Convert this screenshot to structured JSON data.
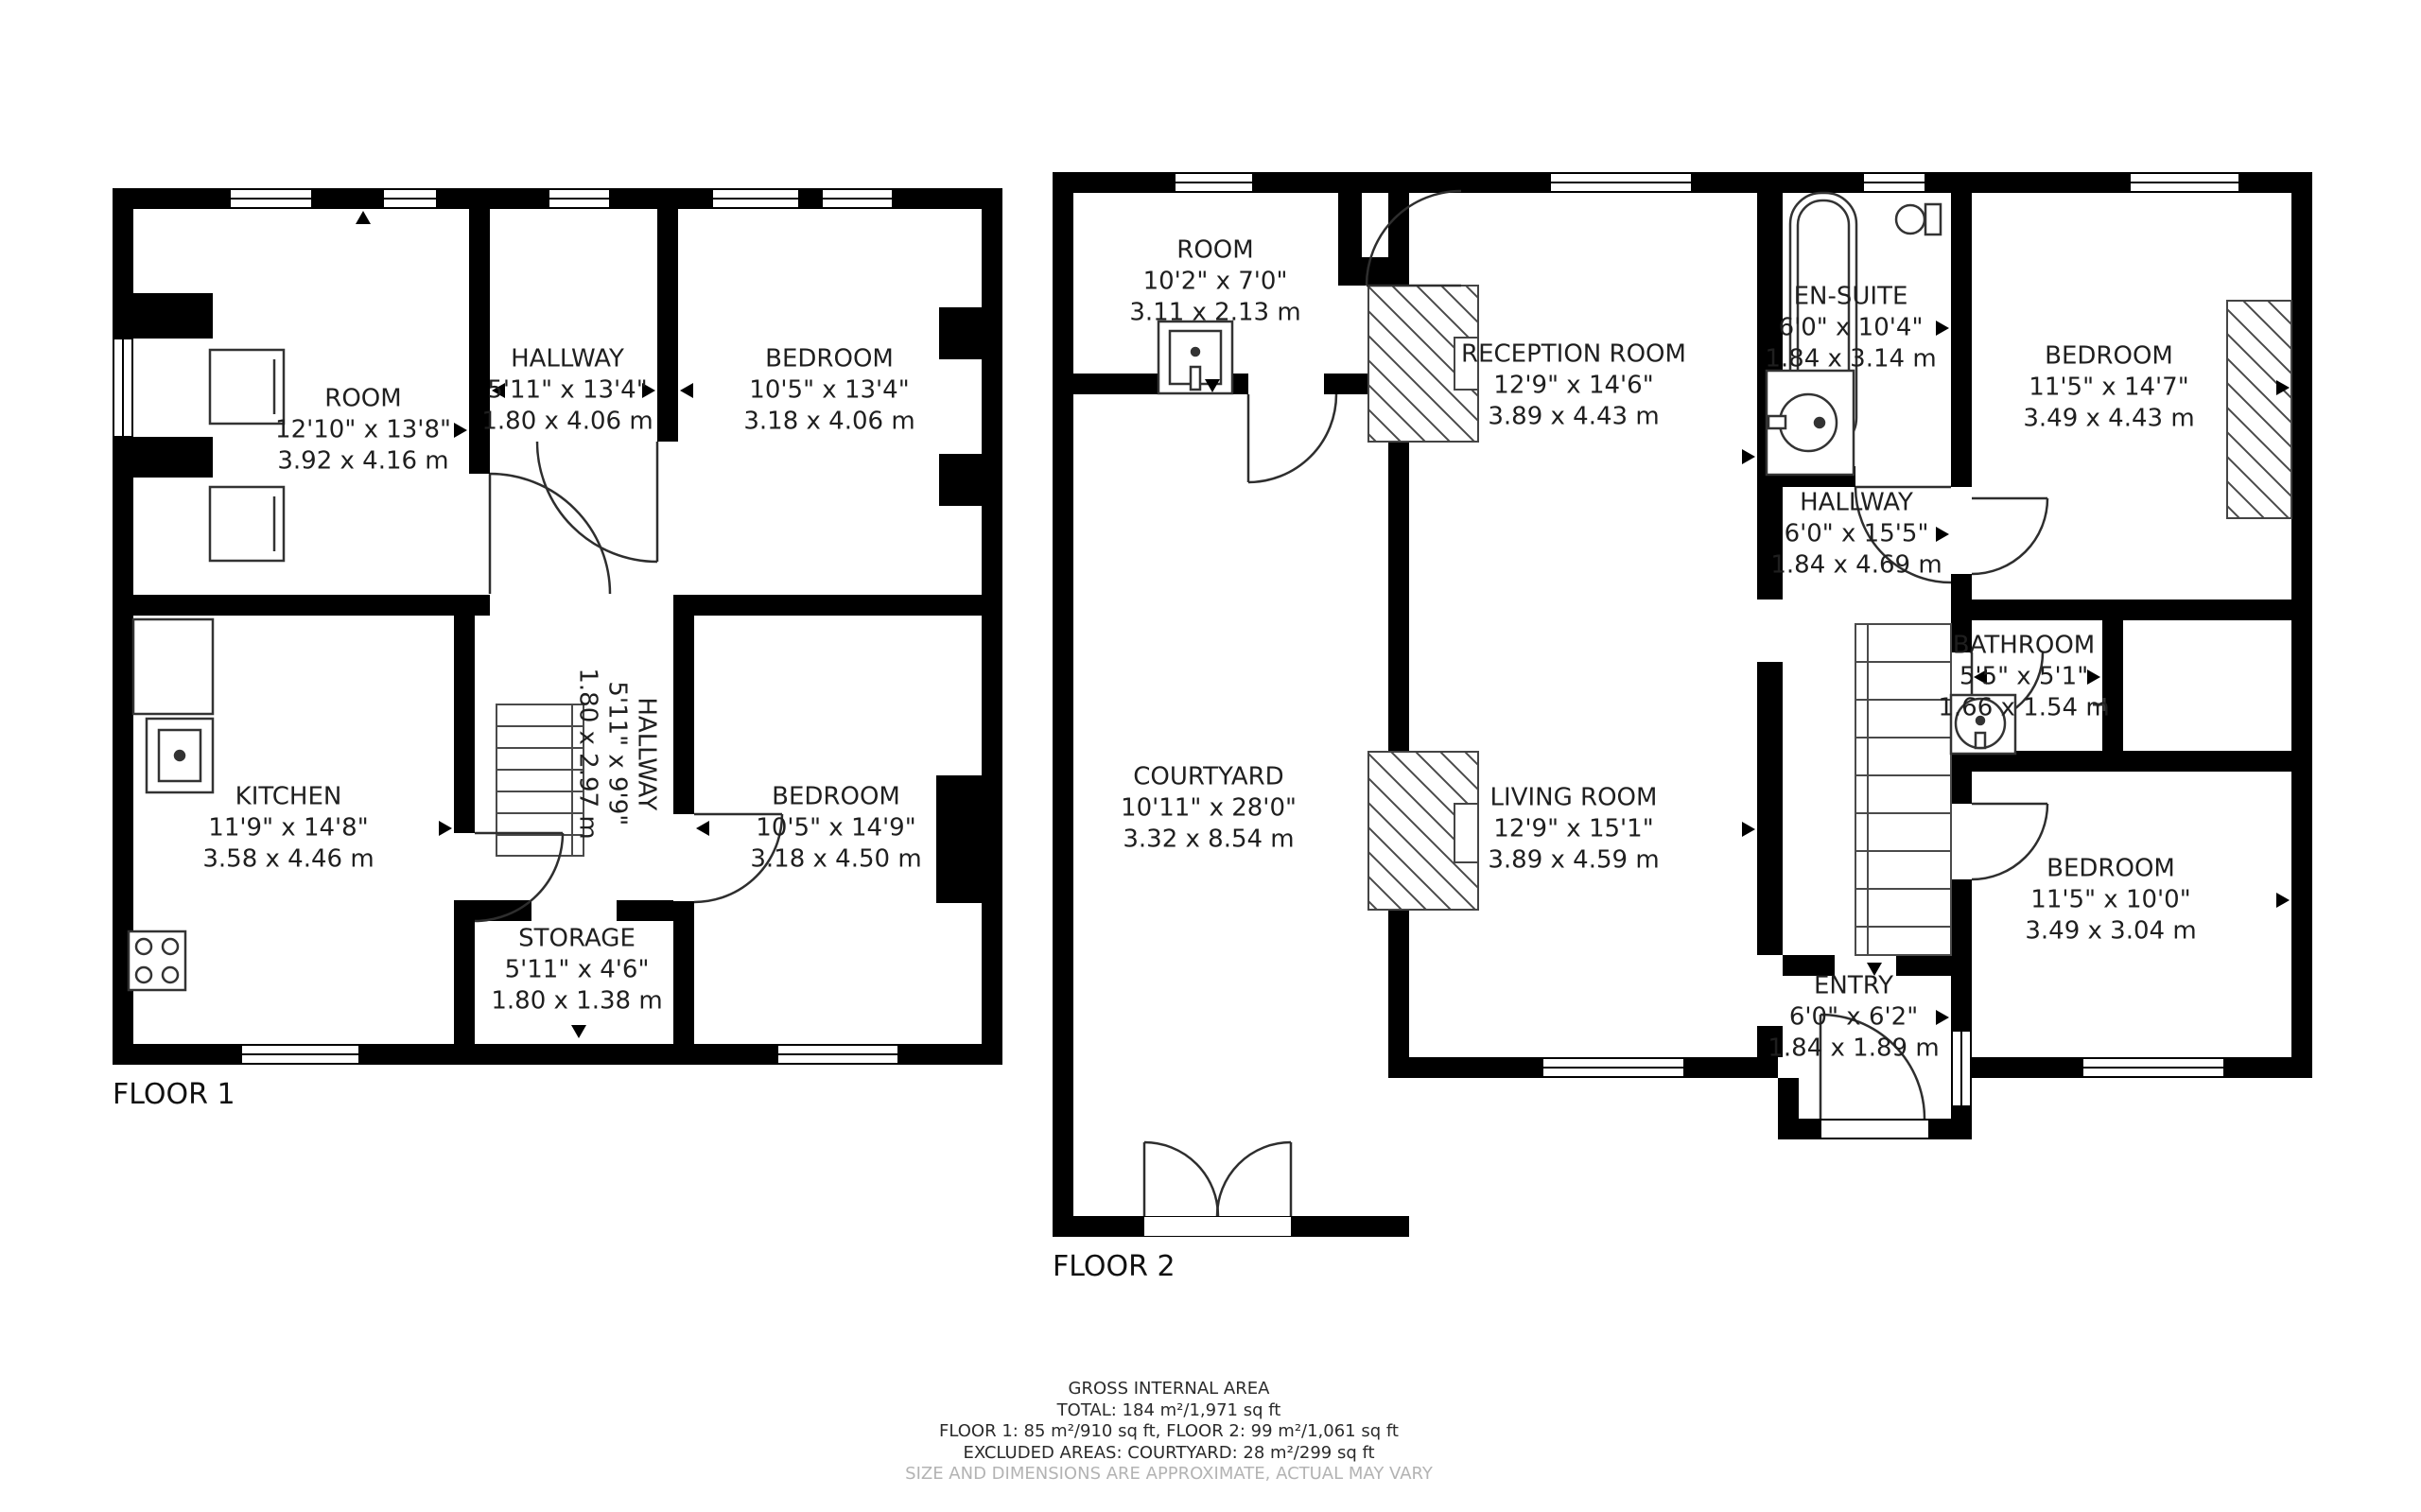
{
  "floor1": {
    "label": "FLOOR 1",
    "rooms": {
      "room": {
        "name": "ROOM",
        "imperial": "12'10\" x 13'8\"",
        "metric": "3.92 x 4.16 m"
      },
      "hallway_top": {
        "name": "HALLWAY",
        "imperial": "5'11\" x 13'4\"",
        "metric": "1.80 x 4.06 m"
      },
      "bedroom_top": {
        "name": "BEDROOM",
        "imperial": "10'5\" x 13'4\"",
        "metric": "3.18 x 4.06 m"
      },
      "kitchen": {
        "name": "KITCHEN",
        "imperial": "11'9\" x 14'8\"",
        "metric": "3.58 x 4.46 m"
      },
      "hallway_stair": {
        "name": "HALLWAY",
        "imperial": "5'11\" x 9'9\"",
        "metric": "1.80 x 2.97 m"
      },
      "bedroom_bot": {
        "name": "BEDROOM",
        "imperial": "10'5\" x 14'9\"",
        "metric": "3.18 x 4.50 m"
      },
      "storage": {
        "name": "STORAGE",
        "imperial": "5'11\" x 4'6\"",
        "metric": "1.80 x 1.38 m"
      }
    }
  },
  "floor2": {
    "label": "FLOOR 2",
    "rooms": {
      "room": {
        "name": "ROOM",
        "imperial": "10'2\" x 7'0\"",
        "metric": "3.11 x 2.13 m"
      },
      "reception": {
        "name": "RECEPTION ROOM",
        "imperial": "12'9\" x 14'6\"",
        "metric": "3.89 x 4.43 m"
      },
      "ensuite": {
        "name": "EN-SUITE",
        "imperial": "6'0\" x 10'4\"",
        "metric": "1.84 x 3.14 m"
      },
      "bedroom_top": {
        "name": "BEDROOM",
        "imperial": "11'5\" x 14'7\"",
        "metric": "3.49 x 4.43 m"
      },
      "hallway": {
        "name": "HALLWAY",
        "imperial": "6'0\" x 15'5\"",
        "metric": "1.84 x 4.69 m"
      },
      "bathroom": {
        "name": "BATHROOM",
        "imperial": "5'5\" x 5'1\"",
        "metric": "1.66 x 1.54 m"
      },
      "courtyard": {
        "name": "COURTYARD",
        "imperial": "10'11\" x 28'0\"",
        "metric": "3.32 x 8.54 m"
      },
      "living": {
        "name": "LIVING ROOM",
        "imperial": "12'9\" x 15'1\"",
        "metric": "3.89 x 4.59 m"
      },
      "bedroom_bot": {
        "name": "BEDROOM",
        "imperial": "11'5\" x 10'0\"",
        "metric": "3.49 x 3.04 m"
      },
      "entry": {
        "name": "ENTRY",
        "imperial": "6'0\" x 6'2\"",
        "metric": "1.84 x 1.89 m"
      }
    }
  },
  "footer": {
    "title": "GROSS INTERNAL AREA",
    "total": "TOTAL: 184 m²/1,971 sq ft",
    "floors": "FLOOR 1: 85 m²/910 sq ft, FLOOR 2: 99 m²/1,061 sq ft",
    "excluded": "EXCLUDED AREAS: COURTYARD: 28 m²/299 sq ft",
    "disclaimer": "SIZE AND DIMENSIONS ARE APPROXIMATE, ACTUAL MAY VARY"
  },
  "colors": {
    "wall": "#000000",
    "line": "#3d3d3d",
    "disclaimer": "#b3b3b3"
  }
}
